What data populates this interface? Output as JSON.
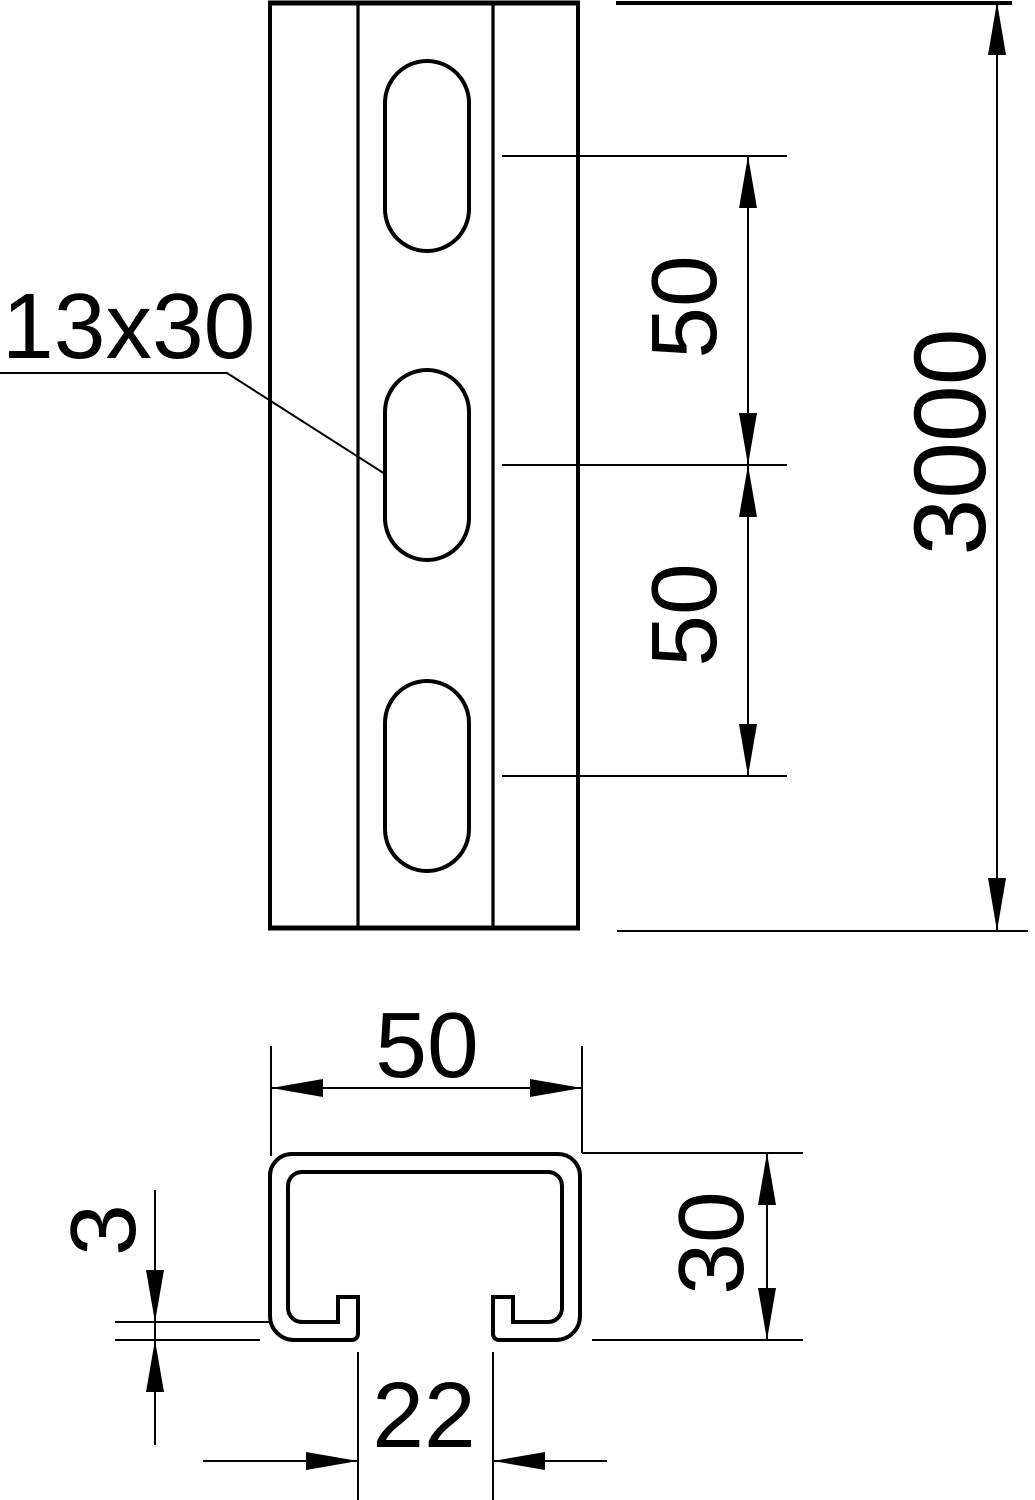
{
  "colors": {
    "line": "#000000",
    "background": "#ffffff"
  },
  "drawing": {
    "title": "C-profile mounting rail, dimension drawing",
    "front_view": {
      "slot_size_label": "13x30",
      "slot_spacing_upper": "50",
      "slot_spacing_lower": "50",
      "rail_length": "3000"
    },
    "section_view": {
      "profile_width": "50",
      "profile_height": "30",
      "opening_width": "22",
      "material_thickness": "3"
    }
  }
}
